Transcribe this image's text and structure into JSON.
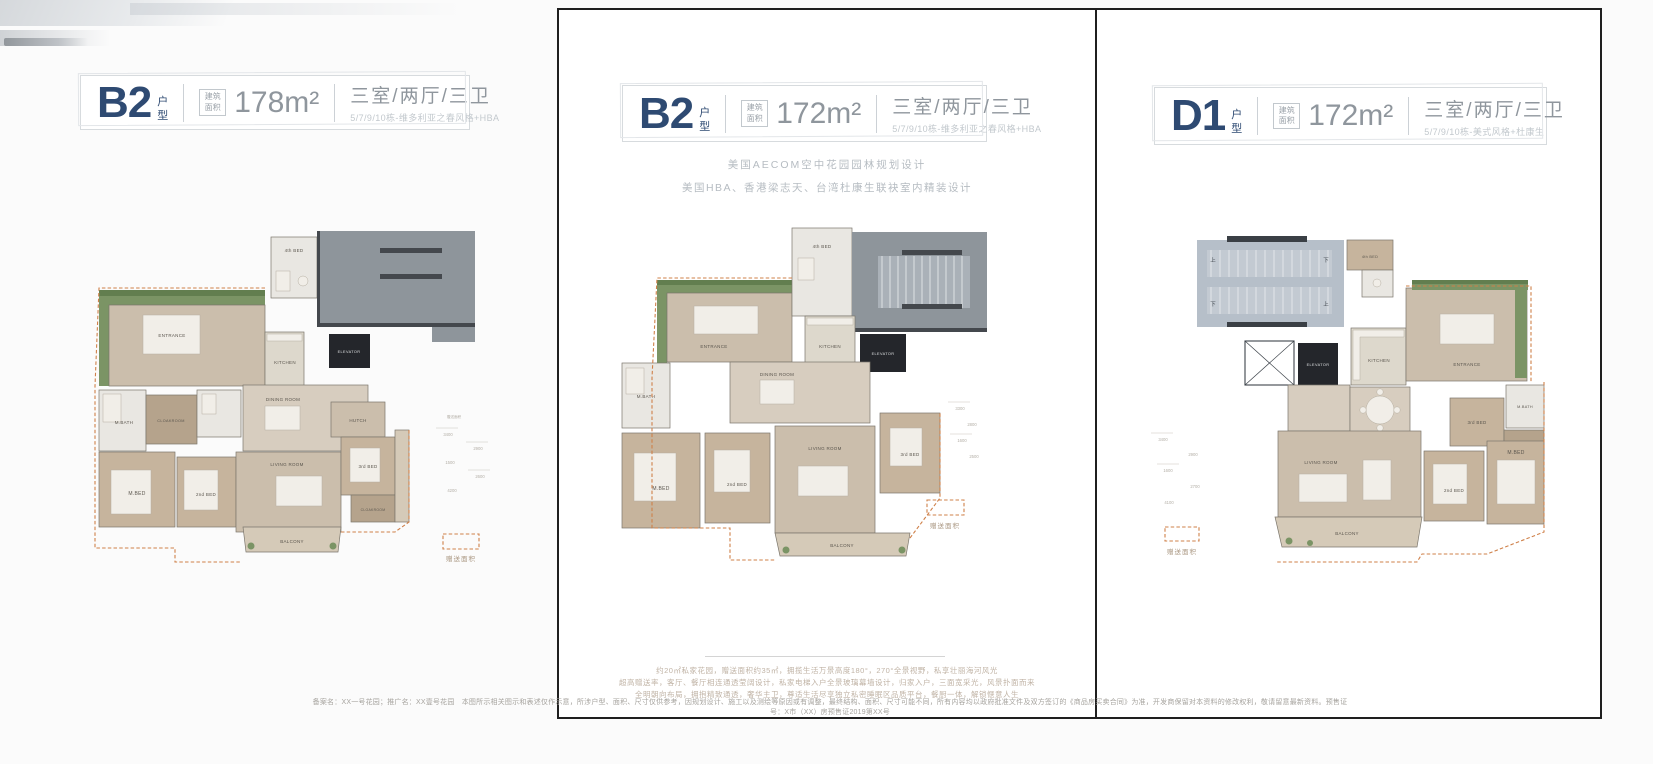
{
  "page": {
    "disclaimer": "备案名：XX一号花园；推广名：XX壹号花园　本图所示相关图示和表述仅作示意，所涉户型、面积、尺寸仅供参考，因规划设计、施工以及测绘等原因或有调整，最终结构、面积、尺寸可能不同，所有内容均以政府批准文件及双方签订的《商品房买卖合同》为准，开发商保留对本资料的修改权利，敬请留意最新资料。预售证号：X市（XX）房预售证2019第XX号"
  },
  "colors": {
    "navy": "#2e4a72",
    "gray_text": "#8f969d",
    "light_gray_text": "#c2c8cd",
    "orange_dash": "#cf8049",
    "roof_gray": "#8e959b",
    "stair_gray": "#b6bfc9",
    "floor_beige": "#cbbeac",
    "wood": "#c6b49d",
    "garden_green": "#7b9465"
  },
  "panels": [
    {
      "code": "B2",
      "code_suffix": "户型",
      "area_label": "建筑面积",
      "area_value": "178m²",
      "spec": "三室/两厅/三卫",
      "spec_sub": "5/7/9/10栋-维多利亚之春风格+HBA",
      "legend_label": "赠送面积",
      "gift_tag": "赠送面积",
      "rooms": {
        "fourth_bed": "4th BED",
        "entrance": "ENTRANCE",
        "kitchen": "KITCHEN",
        "elevator": "ELEVATOR",
        "dining": "DINING ROOM",
        "hutch": "HUTCH",
        "mbath": "M.BATH",
        "cloakroom": "CLOAKROOM",
        "mbed": "M.BED",
        "second_bed": "2nd BED",
        "living": "LIVING ROOM",
        "third_bed": "3rd BED",
        "cloakroom2": "CLOAKROOM",
        "balcony": "BALCONY"
      },
      "dims": [
        "3400",
        "2900",
        "1500",
        "2600",
        "4200"
      ]
    },
    {
      "code": "B2",
      "code_suffix": "户型",
      "area_label": "建筑面积",
      "area_value": "172m²",
      "spec": "三室/两厅/三卫",
      "spec_sub": "5/7/9/10栋-维多利亚之春风格+HBA",
      "legend_label": "赠送面积",
      "top_lines": [
        "美国AECOM空中花园园林规划设计",
        "美国HBA、香港梁志天、台湾杜康生联袂室内精装设计"
      ],
      "bottom_lines": [
        "约20㎡私家花园，赠送面积约35㎡，拥揽生活万景高度180°，270°全景视野，私享壮丽海河风光",
        "超高赠送率，客厅、餐厅相连通透莹阔设计，私家电梯入户全景玻璃幕墙设计，归家入户，三面宽采光，风景扑面而来",
        "全明朝向布局，拥抱精致通透，奢华主卫，尊适生活尽享独立私密睡眠区品质平台，餐厨一体，解锁惬意人生"
      ],
      "rooms": {
        "fourth_bed": "4th BED",
        "entrance": "ENTRANCE",
        "kitchen": "KITCHEN",
        "elevator": "ELEVATOR",
        "dining": "DINING ROOM",
        "mbath": "M.BATH",
        "mbed": "M.BED",
        "second_bed": "2nd BED",
        "living": "LIVING ROOM",
        "third_bed": "3rd BED",
        "balcony": "BALCONY"
      },
      "dims": [
        "3300",
        "2800",
        "1600",
        "2500"
      ]
    },
    {
      "code": "D1",
      "code_suffix": "户型",
      "area_label": "建筑面积",
      "area_value": "172m²",
      "spec": "三室/两厅/三卫",
      "spec_sub": "5/7/9/10栋-美式风格+杜康生",
      "legend_label": "赠送面积",
      "rooms": {
        "fourth_bed": "4th BED",
        "elevator": "ELEVATOR",
        "kitchen": "KITCHEN",
        "entrance": "ENTRANCE",
        "dining": "DINING ROOM",
        "living": "LIVING ROOM",
        "balcony": "BALCONY",
        "second_bed": "2nd BED",
        "third_bed": "3rd BED",
        "mbed": "M.BED",
        "mbath": "M.BATH",
        "cloakroom": "CLOAKROOM",
        "stair_up": "上",
        "stair_down": "下"
      },
      "dims": [
        "3400",
        "2900",
        "1600",
        "2700",
        "4100"
      ]
    }
  ]
}
